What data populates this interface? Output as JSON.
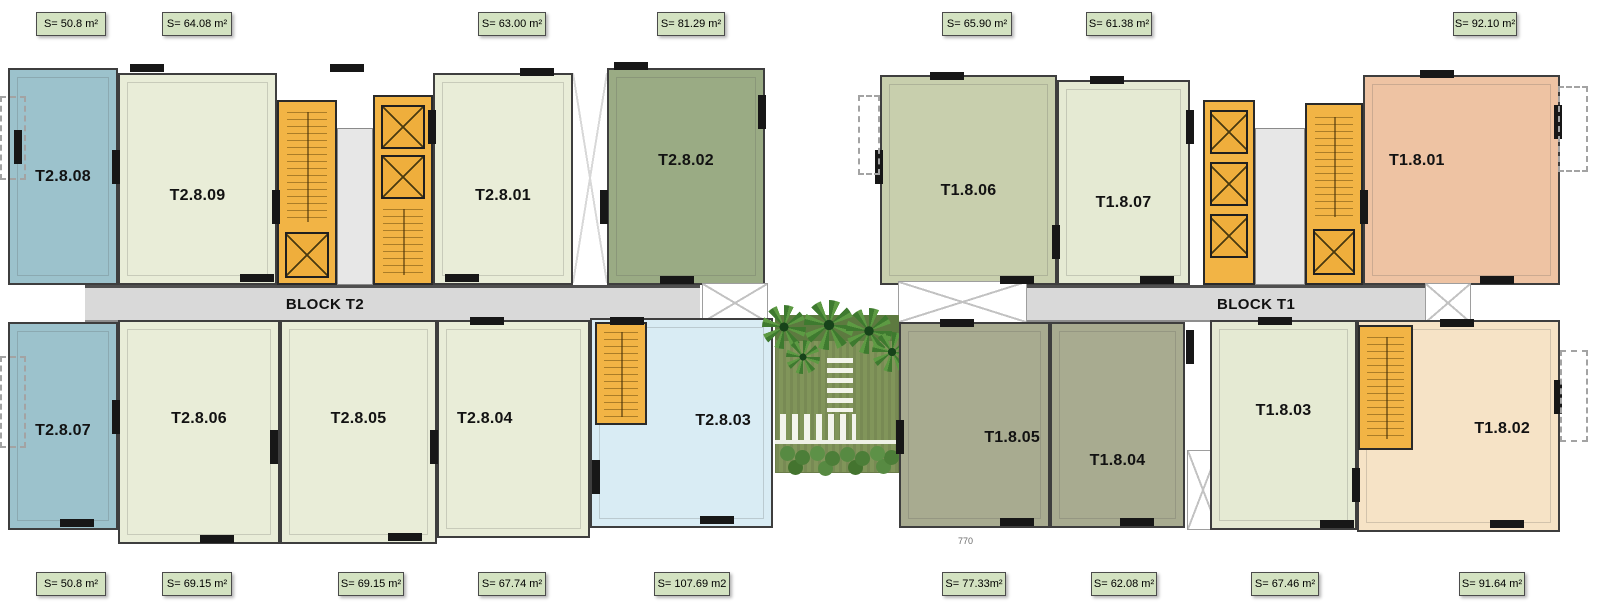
{
  "blocks": {
    "t2_label": "BLOCK T2",
    "t1_label": "BLOCK T1"
  },
  "units": [
    {
      "id": "T2.8.08"
    },
    {
      "id": "T2.8.09"
    },
    {
      "id": "T2.8.01"
    },
    {
      "id": "T2.8.02"
    },
    {
      "id": "T1.8.06"
    },
    {
      "id": "T1.8.07"
    },
    {
      "id": "T1.8.01"
    },
    {
      "id": "T2.8.07"
    },
    {
      "id": "T2.8.06"
    },
    {
      "id": "T2.8.05"
    },
    {
      "id": "T2.8.04"
    },
    {
      "id": "T2.8.03"
    },
    {
      "id": "T1.8.05"
    },
    {
      "id": "T1.8.04"
    },
    {
      "id": "T1.8.03"
    },
    {
      "id": "T1.8.02"
    }
  ],
  "top_areas": [
    "S= 50.8 m²",
    "S= 64.08 m²",
    "S= 63.00 m²",
    "S= 81.29 m²",
    "S= 65.90 m²",
    "S= 61.38 m²",
    "S= 92.10 m²"
  ],
  "bottom_areas": [
    "S= 50.8 m²",
    "S= 69.15 m²",
    "S= 69.15 m²",
    "S= 67.74 m²",
    "S= 107.69 m2",
    "S= 77.33m²",
    "S= 62.08 m²",
    "S= 67.46 m²",
    "S= 91.64 m²"
  ],
  "dimensions": {
    "bottom_right": "770"
  },
  "colors": {
    "unit_blue": "#9cc2cc",
    "unit_cream": "#e9edd8",
    "unit_sage_dark": "#9aab84",
    "unit_sage_mid": "#c8cfad",
    "unit_olive": "#a8ab90",
    "unit_light_blue": "#d9ecf4",
    "unit_peach": "#eec3a3",
    "unit_light_peach": "#f6e3c6",
    "stair_core_orange": "#f2b445",
    "corridor_gray": "#d9d9d9",
    "area_label_green": "#d3e2c1",
    "wall_dark": "#1e1e1e",
    "courtyard_grass": "#81955a"
  }
}
